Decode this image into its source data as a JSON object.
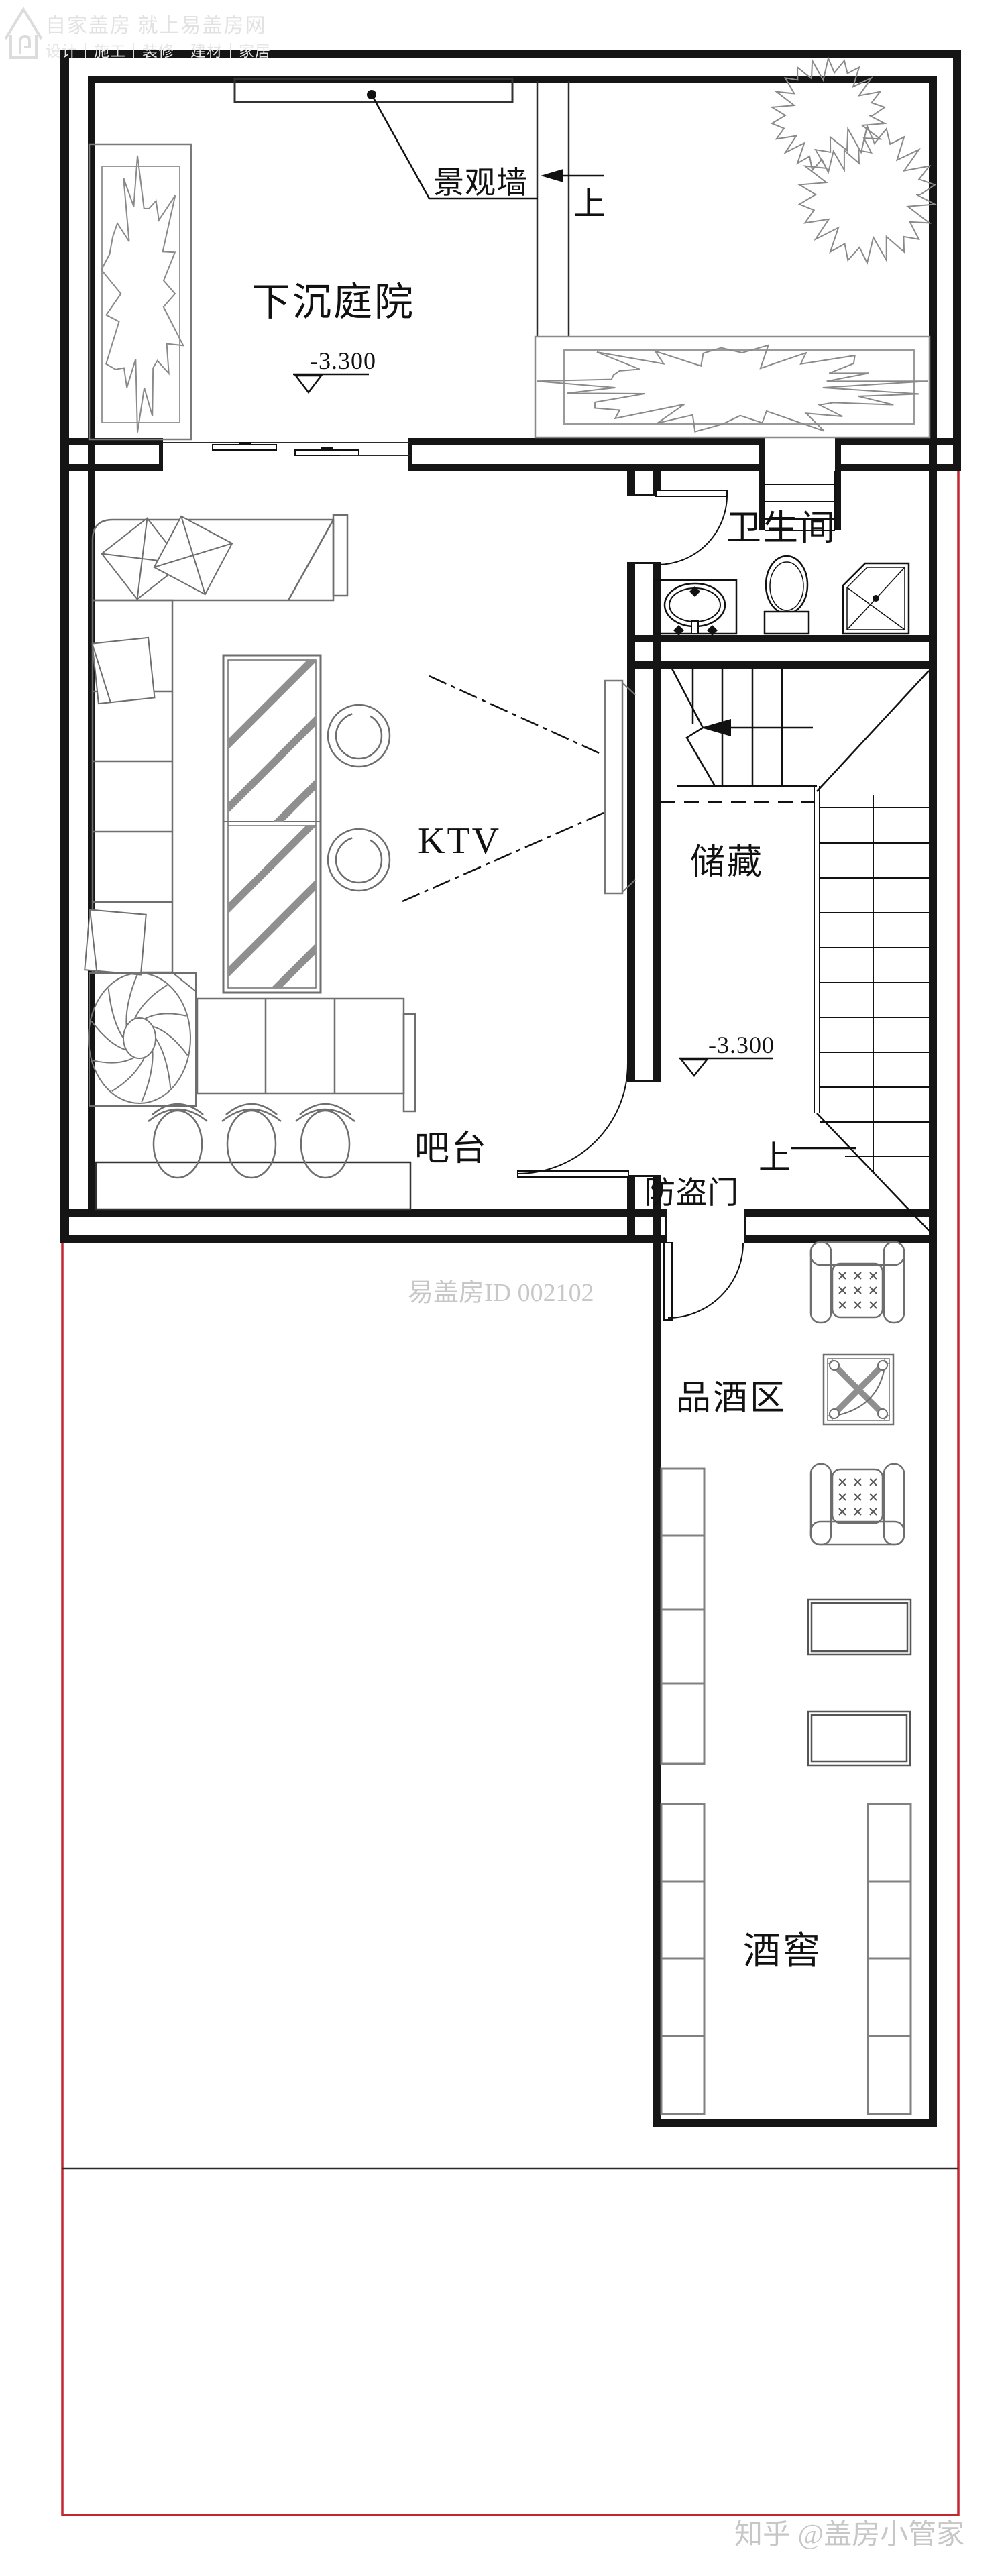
{
  "watermark_top": {
    "line1": "自家盖房 就上易盖房网",
    "line2": "设计｜施工｜装修｜建材｜家居"
  },
  "rooms": {
    "courtyard": "下沉庭院",
    "bathroom": "卫生间",
    "ktv": "KTV",
    "storage": "储藏",
    "bar": "吧台",
    "tasting": "品酒区",
    "cellar": "酒窖"
  },
  "annotations": {
    "landscape_wall": "景观墙",
    "up_courtyard": "上",
    "up_stairs": "上",
    "security_door": "防盗门",
    "elevation_courtyard": "-3.300",
    "elevation_hall": "-3.300"
  },
  "watermarks": {
    "id_text": "易盖房ID 002102",
    "zhihu": "知乎 @盖房小管家"
  },
  "colors": {
    "wall": "#151515",
    "thin_line": "#2a2a2a",
    "furniture": "#6e6e6e",
    "red_boundary": "#c2262e",
    "watermark_gray": "#c7c7c7",
    "logo_gray": "#e2e2e2"
  }
}
